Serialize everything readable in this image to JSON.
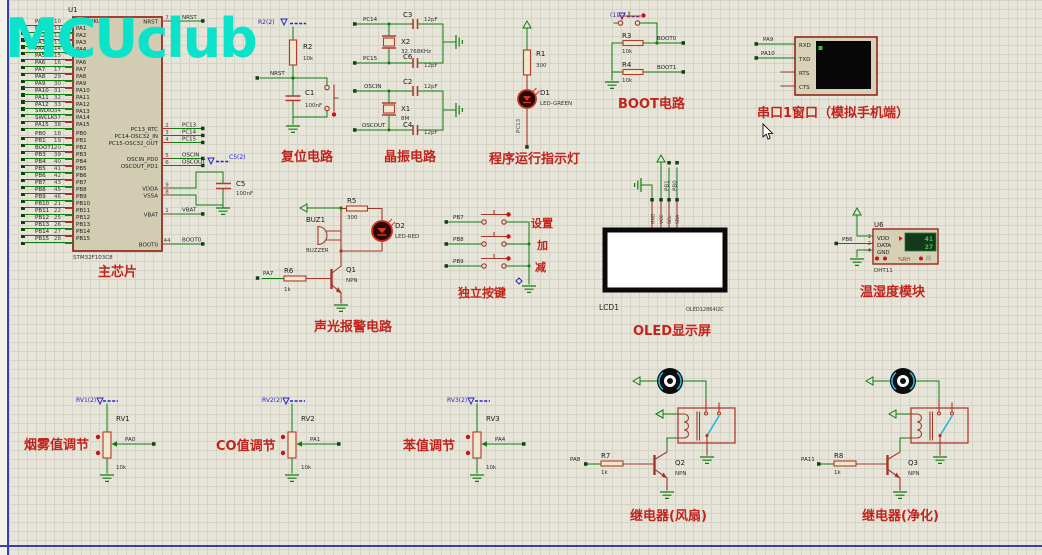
{
  "watermark": "MCUclub",
  "colors": {
    "wire_green": "#0f7d0f",
    "component_red": "#b13a2f",
    "caption_red": "#c1241c",
    "blue_label": "#2525cc",
    "watermark_cyan": "#0ae2c9"
  },
  "chip": {
    "ref": "U1",
    "part": "STM32F103C8",
    "caption": "主芯片",
    "pins_a": [
      {
        "net": "PA0",
        "num": "10",
        "name": "PA0-WKUP"
      },
      {
        "net": "PA1",
        "num": "11",
        "name": "PA1"
      },
      {
        "net": "PA2",
        "num": "12",
        "name": "PA2"
      },
      {
        "net": "PA3",
        "num": "13",
        "name": "PA3"
      },
      {
        "net": "PA4",
        "num": "14",
        "name": "PA4"
      },
      {
        "net": "PA5",
        "num": "15",
        "name": "PA5"
      },
      {
        "net": "PA6",
        "num": "16",
        "name": "PA6"
      },
      {
        "net": "PA7",
        "num": "17",
        "name": "PA7"
      },
      {
        "net": "PA8",
        "num": "29",
        "name": "PA8"
      },
      {
        "net": "PA9",
        "num": "30",
        "name": "PA9"
      },
      {
        "net": "PA10",
        "num": "31",
        "name": "PA10"
      },
      {
        "net": "PA11",
        "num": "32",
        "name": "PA11"
      },
      {
        "net": "PA12",
        "num": "33",
        "name": "PA12"
      },
      {
        "net": "SWDIO",
        "num": "34",
        "name": "PA13"
      },
      {
        "net": "SWCLK",
        "num": "37",
        "name": "PA14"
      },
      {
        "net": "PA15",
        "num": "38",
        "name": "PA15"
      }
    ],
    "pins_b": [
      {
        "net": "PB0",
        "num": "18",
        "name": "PB0"
      },
      {
        "net": "PB1",
        "num": "19",
        "name": "PB1"
      },
      {
        "net": "BOOT1",
        "num": "20",
        "name": "PB2"
      },
      {
        "net": "PB3",
        "num": "39",
        "name": "PB3"
      },
      {
        "net": "PB4",
        "num": "40",
        "name": "PB4"
      },
      {
        "net": "PB5",
        "num": "41",
        "name": "PB5"
      },
      {
        "net": "PB6",
        "num": "42",
        "name": "PB6"
      },
      {
        "net": "PB7",
        "num": "43",
        "name": "PB7"
      },
      {
        "net": "PB8",
        "num": "45",
        "name": "PB8"
      },
      {
        "net": "PB9",
        "num": "46",
        "name": "PB9"
      },
      {
        "net": "PB10",
        "num": "21",
        "name": "PB10"
      },
      {
        "net": "PB11",
        "num": "22",
        "name": "PB11"
      },
      {
        "net": "PB12",
        "num": "25",
        "name": "PB12"
      },
      {
        "net": "PB13",
        "num": "26",
        "name": "PB13"
      },
      {
        "net": "PB14",
        "num": "27",
        "name": "PB14"
      },
      {
        "net": "PB15",
        "num": "28",
        "name": "PB15"
      }
    ],
    "right_pins": [
      {
        "name": "NRST",
        "num": "7",
        "net": "NRST"
      },
      {
        "name": "PC13_RTC",
        "num": "2",
        "net": "PC13"
      },
      {
        "name": "PC14-OSC32_IN",
        "num": "3",
        "net": "PC14"
      },
      {
        "name": "PC15-OSC32_OUT",
        "num": "4",
        "net": "PC15"
      },
      {
        "name": "OSCIN_PD0",
        "num": "5",
        "net": "OSCIN"
      },
      {
        "name": "OSCOUT_PD1",
        "num": "6",
        "net": "OSCOUT"
      },
      {
        "name": "VDDA",
        "num": "9",
        "net": ""
      },
      {
        "name": "VSSA",
        "num": "8",
        "net": ""
      },
      {
        "name": "VBAT",
        "num": "1",
        "net": "VBAT"
      },
      {
        "name": "BOOT0",
        "num": "44",
        "net": "BOOT0"
      }
    ],
    "c5": {
      "power_label": "C5(2)",
      "ref": "C5",
      "val": "100nF"
    }
  },
  "reset": {
    "power_label": "R2(2)",
    "r_ref": "R2",
    "r_val": "10k",
    "net": "NRST",
    "c_ref": "C1",
    "c_val": "100nF",
    "caption": "复位电路"
  },
  "crystal": {
    "caption": "晶振电路",
    "upper": {
      "net_top": "PC14",
      "net_bot": "PC15",
      "c_top_ref": "C3",
      "c_top_val": "12pF",
      "c_bot_ref": "C6",
      "c_bot_val": "12pF",
      "x_ref": "X2",
      "x_val": "32.768KHz"
    },
    "lower": {
      "net_top": "OSCIN",
      "net_bot": "OSCOUT",
      "c_top_ref": "C2",
      "c_top_val": "12pF",
      "c_bot_ref": "C4",
      "c_bot_val": "12pF",
      "x_ref": "X1",
      "x_val": "8M"
    }
  },
  "indicator": {
    "r_ref": "R1",
    "r_val": "300",
    "d_ref": "D1",
    "d_part": "LED-GREEN",
    "net": "PC13",
    "caption": "程序运行指示灯"
  },
  "boot": {
    "power_label": "(1)",
    "r_top_ref": "R3",
    "r_top_val": "10k",
    "net_top": "BOOT0",
    "r_bot_ref": "R4",
    "r_bot_val": "10k",
    "net_bot": "BOOT1",
    "caption": "BOOT电路"
  },
  "serial": {
    "net_rx": "PA9",
    "net_tx": "PA10",
    "pin_labels": [
      "RXD",
      "TXD",
      "RTS",
      "CTS"
    ],
    "caption": "串口1窗口（模拟手机端）"
  },
  "alarm": {
    "buz_ref": "BUZ1",
    "buz_part": "BUZZER",
    "r_top_ref": "R5",
    "r_top_val": "300",
    "d_ref": "D2",
    "d_part": "LED-RED",
    "q_ref": "Q1",
    "q_part": "NPN",
    "r_base_ref": "R6",
    "r_base_val": "1k",
    "net": "PA7",
    "caption": "声光报警电路"
  },
  "keys": {
    "caption": "独立按键",
    "rows": [
      {
        "net": "PB7",
        "label": "设置"
      },
      {
        "net": "PB8",
        "label": "加"
      },
      {
        "net": "PB9",
        "label": "减"
      }
    ]
  },
  "oled": {
    "ref": "LCD1",
    "part": "OLED12864I2C",
    "caption": "OLED显示屏",
    "pin_names": [
      "GND",
      "VCC",
      "SCL",
      "SDA"
    ],
    "wire_labels": [
      "PB1",
      "PB0"
    ]
  },
  "dht": {
    "ref": "U6",
    "part": "DHT11",
    "caption": "温湿度模块",
    "pin_nums": [
      "1",
      "2",
      "4"
    ],
    "pin_names": [
      "VDD",
      "DATA",
      "GND"
    ],
    "net": "PB6",
    "display_top": "41",
    "display_bottom": "27",
    "unit": "%RH"
  },
  "pots": [
    {
      "power_label": "RV1(2)",
      "ref": "RV1",
      "val": "10k",
      "net": "PA0",
      "caption": "烟雾值调节"
    },
    {
      "power_label": "RV2(2)",
      "ref": "RV2",
      "val": "10k",
      "net": "PA1",
      "caption": "CO值调节"
    },
    {
      "power_label": "RV3(2)",
      "ref": "RV3",
      "val": "10k",
      "net": "PA4",
      "caption": "苯值调节"
    }
  ],
  "relays": [
    {
      "r_ref": "R7",
      "r_val": "1k",
      "net": "PA8",
      "q_ref": "Q2",
      "q_part": "NPN",
      "caption": "继电器(风扇)"
    },
    {
      "r_ref": "R8",
      "r_val": "1k",
      "net": "PA11",
      "q_ref": "Q3",
      "q_part": "NPN",
      "caption": "继电器(净化)"
    }
  ]
}
